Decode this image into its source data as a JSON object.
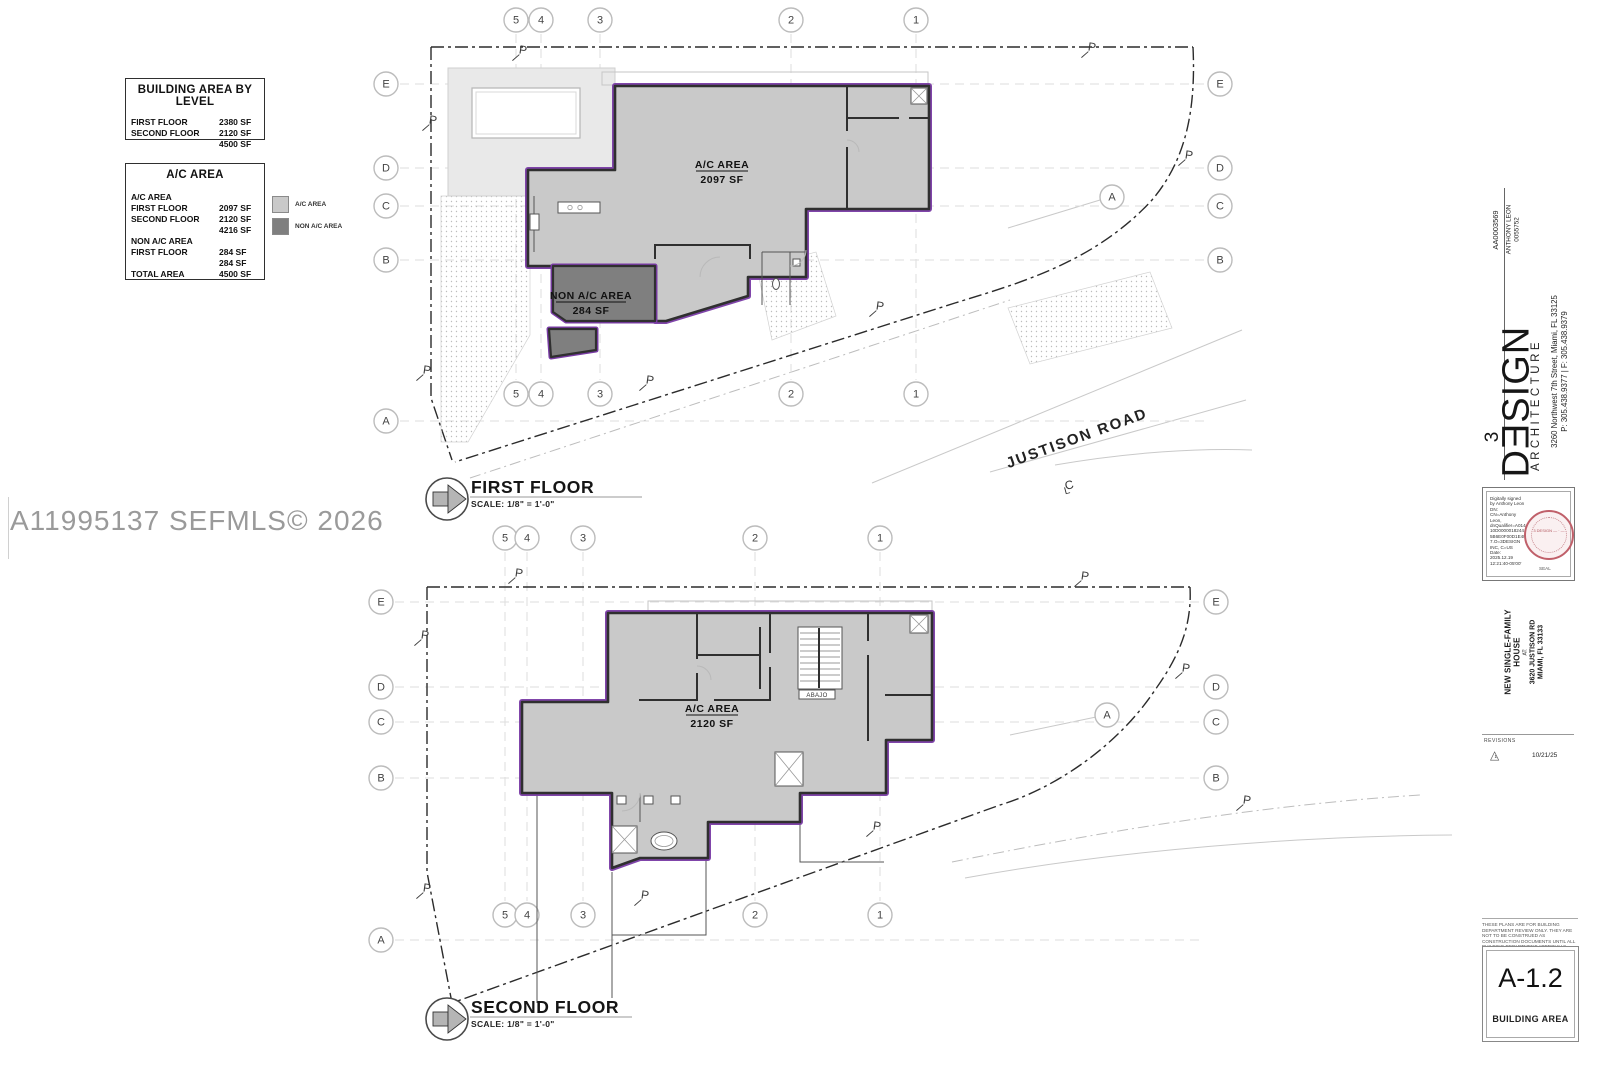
{
  "watermark": "A11995137  SEFMLS© 2026",
  "colors": {
    "ac_fill": "#c9c9c9",
    "non_ac_fill": "#7f7f7f",
    "outline_purple": "#7a3ca6",
    "seal_red": "#c0606a"
  },
  "grid": {
    "columns": [
      "5",
      "4",
      "3",
      "2",
      "1"
    ],
    "rows": [
      "E",
      "D",
      "C",
      "B",
      "A"
    ],
    "extra": "A"
  },
  "symbols": {
    "property_line": "P",
    "centerline_c": "C",
    "centerline_l": "L",
    "revision_triangle": "△"
  },
  "tables": {
    "building_area": {
      "title": "BUILDING AREA BY LEVEL",
      "rows": [
        {
          "label": "FIRST FLOOR",
          "value": "2380 SF"
        },
        {
          "label": "SECOND FLOOR",
          "value": "2120 SF"
        },
        {
          "label": "",
          "value": "4500 SF"
        }
      ]
    },
    "ac_area": {
      "title": "A/C AREA",
      "rows": [
        {
          "label": "A/C AREA",
          "value": ""
        },
        {
          "label": "FIRST FLOOR",
          "value": "2097 SF"
        },
        {
          "label": "SECOND FLOOR",
          "value": "2120 SF"
        },
        {
          "label": "",
          "value": "4216 SF"
        },
        {
          "label": "NON A/C AREA",
          "value": ""
        },
        {
          "label": "FIRST FLOOR",
          "value": "284 SF"
        },
        {
          "label": "",
          "value": "284 SF"
        },
        {
          "label": "TOTAL AREA",
          "value": "4500 SF"
        }
      ]
    },
    "legend": [
      {
        "swatch": "#c9c9c9",
        "label": "A/C AREA"
      },
      {
        "swatch": "#7f7f7f",
        "label": "NON A/C AREA"
      }
    ]
  },
  "plans": {
    "first": {
      "title": "FIRST FLOOR",
      "scale": "SCALE:  1/8\" = 1'-0\"",
      "ac_label": "A/C AREA",
      "ac_value": "2097 SF",
      "non_ac_label": "NON A/C AREA",
      "non_ac_value": "284 SF",
      "road": "JUSTISON ROAD"
    },
    "second": {
      "title": "SECOND FLOOR",
      "scale": "SCALE:  1/8\" = 1'-0\"",
      "ac_label": "A/C AREA",
      "ac_value": "2120 SF",
      "stair_label": "ABAJO"
    }
  },
  "titleblock": {
    "license": "AA0003569",
    "architect": "ANTHONY LEON",
    "architect_license": "0055752",
    "logo_number": "3",
    "logo_name": "DƎSIGN",
    "logo_sub": "ARCHITECTURE",
    "address": "3260 Northwest 7th Street, Miami, FL 33125",
    "phone": "P: 305.438.9377  |  F: 305.438.9379",
    "signature": "Digitally signed\nby Anthony Leon\nDN:\nCN=Anthony\nLeon,\ndnQualifier=A014\n10D0000018244\n5B6E0F00D1E4F\n7.O=3DESIGN\nINC, C=US\nDate:\n2025.12.19\n12:21:40-05'00'",
    "seal_suffix": "SEAL",
    "seal_text": "3 DESIGN — · —",
    "project_name": "NEW SINGLE-FAMILY HOUSE",
    "project_at": "AT:",
    "project_address1": "3620 JUSTISON RD",
    "project_address2": "MIAMI, FL 33133",
    "revisions_label": "REVISIONS",
    "revision_no": "1",
    "revision_date": "10/21/25",
    "disclaimer": "THESE PLANS ARE FOR BUILDING DEPARTMENT REVIEW ONLY.  THEY ARE NOT TO BE CONSTRUED AS CONSTRUCTION DOCUMENTS UNTIL ALL BUILDING DEPARTMENT APPROVALS ARE OBTAINED.",
    "sheet_number": "A-1.2",
    "sheet_title": "BUILDING AREA"
  }
}
